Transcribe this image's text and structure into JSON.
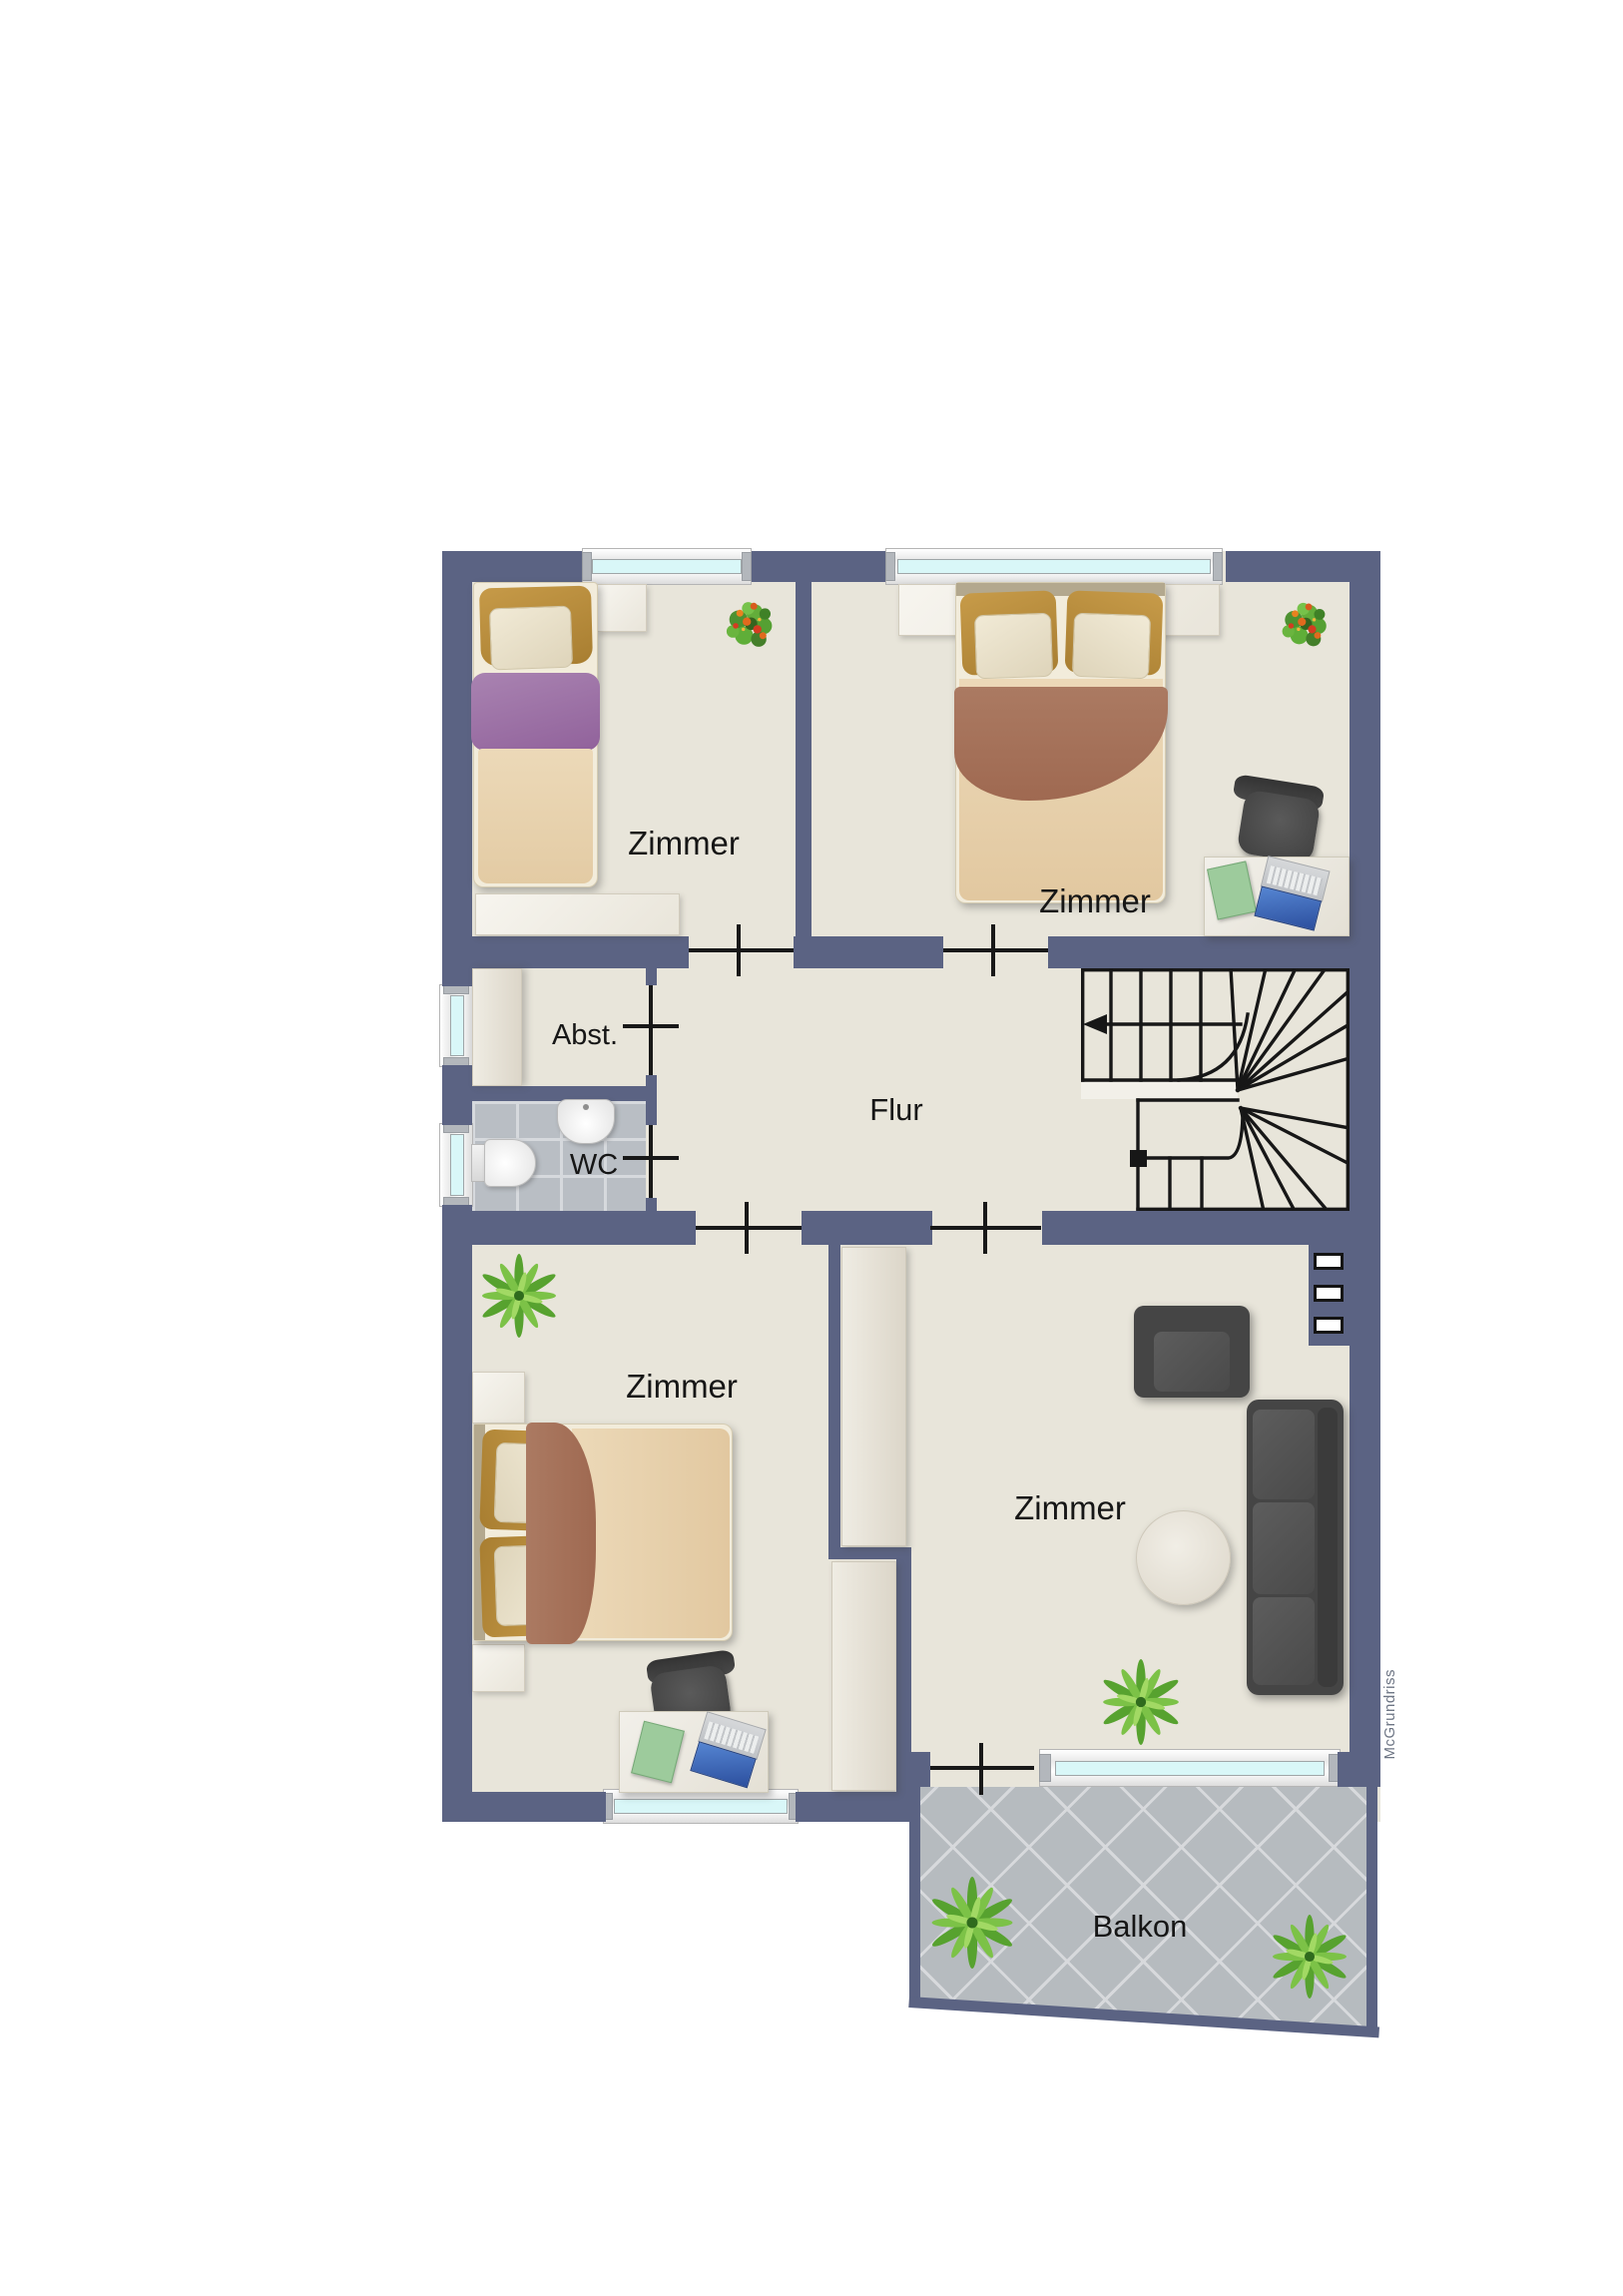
{
  "rooms": {
    "top_left_bedroom": {
      "label": "Zimmer"
    },
    "top_right_bedroom": {
      "label": "Zimmer"
    },
    "storage": {
      "label": "Abst."
    },
    "wc": {
      "label": "WC"
    },
    "hallway": {
      "label": "Flur"
    },
    "bottom_left_bedroom": {
      "label": "Zimmer"
    },
    "living_room": {
      "label": "Zimmer"
    },
    "balcony": {
      "label": "Balkon"
    }
  },
  "stairs": {
    "arrow_direction": "left"
  },
  "watermark": {
    "text": "McGrundriss"
  },
  "colors": {
    "wall": "#5b6383",
    "floor": "#e8e5da",
    "window_glass": "#d9f7f8",
    "wc_tile": "#b9bec4",
    "balcony_tile": "#b6bbbf",
    "door_line": "#181818",
    "label_text": "#161616",
    "watermark_text": "#6d7584"
  }
}
